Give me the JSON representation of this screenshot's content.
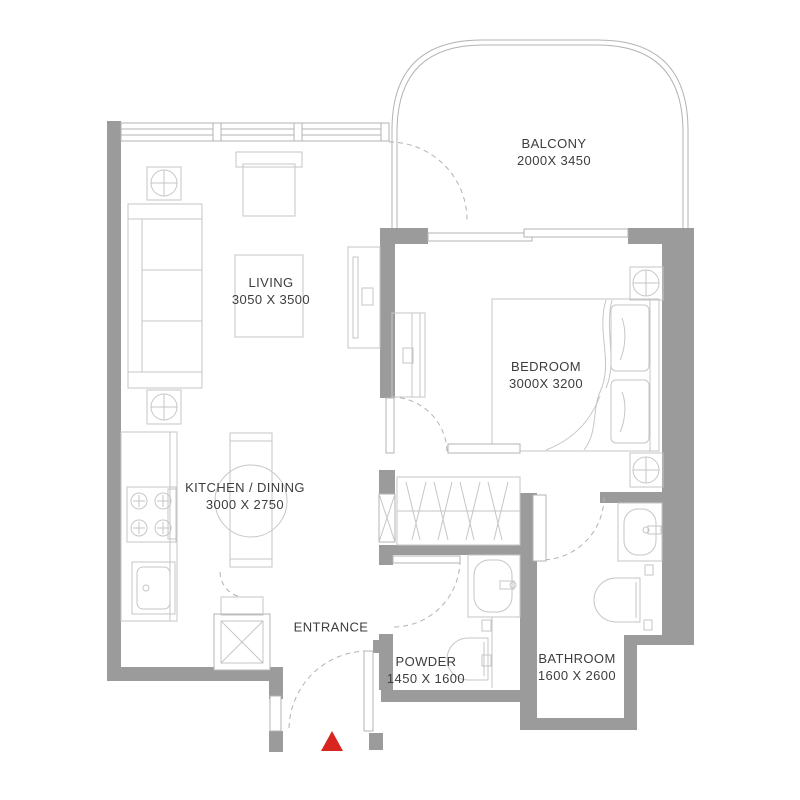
{
  "plan": {
    "title": "One-bedroom apartment floor plan",
    "rooms": [
      {
        "id": "balcony",
        "label": "BALCONY",
        "dims": "2000X 3450"
      },
      {
        "id": "living",
        "label": "LIVING",
        "dims": "3050 X 3500"
      },
      {
        "id": "bedroom",
        "label": "BEDROOM",
        "dims": "3000X 3200"
      },
      {
        "id": "kitchen",
        "label": "KITCHEN / DINING",
        "dims": "3000 X 2750"
      },
      {
        "id": "entrance",
        "label": "ENTRANCE",
        "dims": ""
      },
      {
        "id": "powder",
        "label": "POWDER",
        "dims": "1450 X 1600"
      },
      {
        "id": "bathroom",
        "label": "BATHROOM",
        "dims": "1600 X 2600"
      }
    ],
    "colors": {
      "wall": "#9b9b9b",
      "line": "#b3b3b3",
      "furniture": "#c6c6c6",
      "text": "#3d3d3d",
      "marker": "#d9251f",
      "background": "#ffffff"
    }
  }
}
